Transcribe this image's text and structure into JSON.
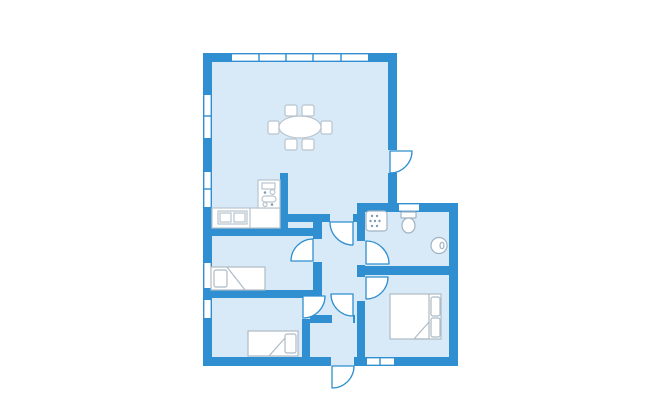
{
  "canvas": {
    "w": 650,
    "h": 420,
    "bg": "#ffffff"
  },
  "colors": {
    "wall": "#2f8fd0",
    "floor": "#d8eaf8",
    "white": "#ffffff",
    "furniture": "#b9c4cd",
    "fixture": "#9fb3c2",
    "bed": "#aebbc5",
    "dots": "#7c9cb4"
  },
  "plan": {
    "blocks": [
      {
        "name": "left-wing-floor",
        "x": 203,
        "y": 53,
        "w": 194,
        "h": 313
      },
      {
        "name": "right-wing-floor",
        "x": 357,
        "y": 203,
        "w": 101,
        "h": 163
      }
    ],
    "walls": [
      {
        "name": "exterior-wall-top",
        "x": 203,
        "y": 53,
        "w": 194,
        "h": 9
      },
      {
        "name": "exterior-wall-left",
        "x": 203,
        "y": 53,
        "w": 9,
        "h": 313
      },
      {
        "name": "living-room-east-wall",
        "x": 388,
        "y": 53,
        "w": 9,
        "h": 159
      },
      {
        "name": "bathroom-north-wall",
        "x": 357,
        "y": 203,
        "w": 101,
        "h": 9
      },
      {
        "name": "exterior-wall-right",
        "x": 449,
        "y": 203,
        "w": 9,
        "h": 163
      },
      {
        "name": "exterior-wall-bottom",
        "x": 203,
        "y": 357,
        "w": 255,
        "h": 9
      },
      {
        "name": "kitchen-partition-wall",
        "x": 280,
        "y": 173,
        "w": 8,
        "h": 63
      },
      {
        "name": "hallway-north-wall",
        "x": 288,
        "y": 214,
        "w": 69,
        "h": 8
      },
      {
        "name": "hallway-west-wall",
        "x": 313,
        "y": 222,
        "w": 9,
        "h": 76
      },
      {
        "name": "bedroom1-north-wall",
        "x": 203,
        "y": 228,
        "w": 119,
        "h": 8
      },
      {
        "name": "bedroom1-south-wall",
        "x": 203,
        "y": 290,
        "w": 119,
        "h": 8
      },
      {
        "name": "bedroom2-east-wall",
        "x": 302,
        "y": 298,
        "w": 8,
        "h": 59
      },
      {
        "name": "bathroom-west-wall",
        "x": 357,
        "y": 212,
        "w": 8,
        "h": 62
      },
      {
        "name": "bathroom-south-wall",
        "x": 357,
        "y": 266,
        "w": 92,
        "h": 9
      },
      {
        "name": "master-bedroom-west-wall",
        "x": 357,
        "y": 275,
        "w": 8,
        "h": 82
      },
      {
        "name": "entry-north-wall",
        "x": 310,
        "y": 315,
        "w": 45,
        "h": 8
      }
    ],
    "door_gaps": [
      {
        "name": "terrace-door-gap",
        "x": 388,
        "y": 150,
        "w": 9,
        "h": 23
      },
      {
        "name": "living-hall-door-gap",
        "x": 330,
        "y": 214,
        "w": 23,
        "h": 8
      },
      {
        "name": "bedroom1-door-gap",
        "x": 313,
        "y": 239,
        "w": 9,
        "h": 23
      },
      {
        "name": "bathroom-door-gap",
        "x": 357,
        "y": 241,
        "w": 8,
        "h": 24
      },
      {
        "name": "master-door-gap",
        "x": 357,
        "y": 277,
        "w": 8,
        "h": 24
      },
      {
        "name": "bedroom2-door-gap",
        "x": 302,
        "y": 298,
        "w": 8,
        "h": 21
      },
      {
        "name": "entry-door-gap",
        "x": 332,
        "y": 315,
        "w": 21,
        "h": 8
      },
      {
        "name": "front-door-gap",
        "x": 331,
        "y": 357,
        "w": 23,
        "h": 9
      }
    ],
    "windows": [
      {
        "name": "living-room-window-north",
        "x": 232,
        "y": 53,
        "w": 136,
        "h": 9,
        "ticks": [
          259,
          286,
          313,
          341
        ]
      },
      {
        "name": "living-room-window-west",
        "x": 203,
        "y": 95,
        "w": 9,
        "h": 43,
        "ticks": [
          116
        ]
      },
      {
        "name": "kitchen-window-west",
        "x": 203,
        "y": 172,
        "w": 9,
        "h": 35,
        "ticks": [
          189
        ]
      },
      {
        "name": "bedroom1-window-west",
        "x": 203,
        "y": 263,
        "w": 9,
        "h": 25,
        "ticks": []
      },
      {
        "name": "bedroom2-window-west",
        "x": 203,
        "y": 300,
        "w": 9,
        "h": 18,
        "ticks": []
      },
      {
        "name": "bathroom-window-north",
        "x": 399,
        "y": 203,
        "w": 20,
        "h": 9,
        "ticks": []
      },
      {
        "name": "master-bedroom-window-south",
        "x": 367,
        "y": 357,
        "w": 27,
        "h": 9,
        "ticks": [
          380
        ]
      }
    ],
    "doors": [
      {
        "name": "terrace-door-swing",
        "hx": 390,
        "hy": 151,
        "r": 22,
        "corner": "tl"
      },
      {
        "name": "living-hall-door-swing",
        "hx": 353,
        "hy": 222,
        "r": 23,
        "corner": "tr"
      },
      {
        "name": "bedroom1-door-swing",
        "hx": 313,
        "hy": 261,
        "r": 22,
        "corner": "br"
      },
      {
        "name": "bathroom-door-swing",
        "hx": 366,
        "hy": 264,
        "r": 23,
        "corner": "bl"
      },
      {
        "name": "master-bedroom-door-swing",
        "hx": 366,
        "hy": 277,
        "r": 22,
        "corner": "tl"
      },
      {
        "name": "bedroom2-door-swing",
        "hx": 303,
        "hy": 296,
        "r": 22,
        "corner": "tl"
      },
      {
        "name": "entry-door-swing",
        "hx": 353,
        "hy": 294,
        "r": 22,
        "corner": "tr"
      },
      {
        "name": "front-door-swing",
        "hx": 332,
        "hy": 366,
        "r": 22,
        "corner": "tl"
      }
    ],
    "furniture": [
      {
        "type": "rect",
        "name": "dining-chair",
        "x": 285,
        "y": 105,
        "w": 12,
        "h": 11,
        "rx": 2,
        "stroke": "furniture"
      },
      {
        "type": "rect",
        "name": "dining-chair",
        "x": 302,
        "y": 105,
        "w": 12,
        "h": 11,
        "rx": 2,
        "stroke": "furniture"
      },
      {
        "type": "rect",
        "name": "dining-chair",
        "x": 285,
        "y": 139,
        "w": 12,
        "h": 11,
        "rx": 2,
        "stroke": "furniture"
      },
      {
        "type": "rect",
        "name": "dining-chair",
        "x": 302,
        "y": 139,
        "w": 12,
        "h": 11,
        "rx": 2,
        "stroke": "furniture"
      },
      {
        "type": "rect",
        "name": "dining-chair",
        "x": 268,
        "y": 121,
        "w": 11,
        "h": 13,
        "rx": 2,
        "stroke": "furniture"
      },
      {
        "type": "rect",
        "name": "dining-chair",
        "x": 321,
        "y": 121,
        "w": 11,
        "h": 13,
        "rx": 2,
        "stroke": "furniture"
      },
      {
        "type": "ellipse",
        "name": "dining-table",
        "cx": 300,
        "cy": 127,
        "rx": 21,
        "ry": 11,
        "stroke": "furniture"
      },
      {
        "type": "rect",
        "name": "kitchen-counter",
        "x": 212,
        "y": 208,
        "w": 68,
        "h": 20,
        "stroke": "furniture"
      },
      {
        "type": "line",
        "name": "kitchen-counter-seam",
        "x1": 250,
        "y1": 208,
        "x2": 250,
        "y2": 228,
        "stroke": "furniture"
      },
      {
        "type": "rect",
        "name": "kitchen-sink",
        "x": 218,
        "y": 211,
        "w": 29,
        "h": 13,
        "stroke": "furniture"
      },
      {
        "type": "rect",
        "name": "kitchen-sink-bowl",
        "x": 220,
        "y": 213,
        "w": 11,
        "h": 9,
        "stroke": "furniture"
      },
      {
        "type": "rect",
        "name": "kitchen-sink-bowl",
        "x": 234,
        "y": 213,
        "w": 11,
        "h": 9,
        "stroke": "furniture"
      },
      {
        "type": "rect",
        "name": "stove-unit",
        "x": 258,
        "y": 180,
        "w": 22,
        "h": 28,
        "stroke": "furniture"
      },
      {
        "type": "rect",
        "name": "stove-panel",
        "x": 262,
        "y": 183,
        "w": 13,
        "h": 6,
        "stroke": "furniture"
      },
      {
        "type": "dot",
        "name": "stove-burner",
        "cx": 265,
        "cy": 192.5,
        "r": 1.3
      },
      {
        "type": "circle",
        "name": "stove-burner",
        "cx": 272.5,
        "cy": 192,
        "r": 2.4,
        "stroke": "furniture"
      },
      {
        "type": "rect",
        "name": "stove-oven",
        "x": 262,
        "y": 196,
        "w": 14,
        "h": 6,
        "rx": 3,
        "stroke": "furniture"
      },
      {
        "type": "circle",
        "name": "stove-burner",
        "cx": 265,
        "cy": 204.5,
        "r": 2,
        "stroke": "furniture"
      },
      {
        "type": "dot",
        "name": "stove-burner",
        "cx": 272,
        "cy": 204.5,
        "r": 1.3
      },
      {
        "type": "rect",
        "name": "shower",
        "x": 366,
        "y": 211,
        "w": 21,
        "h": 20,
        "rx": 3,
        "stroke": "fixture"
      },
      {
        "type": "dot",
        "name": "shower-dot",
        "cx": 372,
        "cy": 216,
        "r": 1.2
      },
      {
        "type": "dot",
        "name": "shower-dot",
        "cx": 377,
        "cy": 216,
        "r": 1.2
      },
      {
        "type": "dot",
        "name": "shower-dot",
        "cx": 370.5,
        "cy": 221,
        "r": 1.2
      },
      {
        "type": "dot",
        "name": "shower-dot",
        "cx": 375,
        "cy": 221,
        "r": 1.2
      },
      {
        "type": "dot",
        "name": "shower-dot",
        "cx": 379.5,
        "cy": 221,
        "r": 1.2
      },
      {
        "type": "dot",
        "name": "shower-dot",
        "cx": 372,
        "cy": 226,
        "r": 1.2
      },
      {
        "type": "dot",
        "name": "shower-dot",
        "cx": 377,
        "cy": 226,
        "r": 1.2
      },
      {
        "type": "rect",
        "name": "toilet-tank",
        "x": 401,
        "y": 212,
        "w": 15,
        "h": 6,
        "rx": 1,
        "stroke": "fixture"
      },
      {
        "type": "ellipse",
        "name": "toilet-bowl",
        "cx": 408.5,
        "cy": 225.5,
        "rx": 6.5,
        "ry": 7.5,
        "stroke": "fixture"
      },
      {
        "type": "circle",
        "name": "washbasin",
        "cx": 439,
        "cy": 245.5,
        "r": 8,
        "stroke": "fixture"
      },
      {
        "type": "ellipse",
        "name": "washbasin-tap",
        "cx": 442,
        "cy": 245.5,
        "rx": 2,
        "ry": 3.2,
        "stroke": "fixture"
      },
      {
        "type": "rect",
        "name": "single-bed-1",
        "x": 211,
        "y": 267,
        "w": 54,
        "h": 23,
        "stroke": "bed"
      },
      {
        "type": "rect",
        "name": "single-bed-1-pillow",
        "x": 214,
        "y": 270,
        "w": 13,
        "h": 17,
        "rx": 2,
        "stroke": "bed"
      },
      {
        "type": "line",
        "name": "single-bed-1-fold",
        "x1": 227,
        "y1": 267,
        "x2": 245,
        "y2": 290,
        "stroke": "bed"
      },
      {
        "type": "rect",
        "name": "single-bed-2",
        "x": 248,
        "y": 331,
        "w": 50,
        "h": 25,
        "stroke": "bed"
      },
      {
        "type": "rect",
        "name": "single-bed-2-pillow",
        "x": 285,
        "y": 334,
        "w": 11,
        "h": 19,
        "rx": 2,
        "stroke": "bed"
      },
      {
        "type": "line",
        "name": "single-bed-2-fold",
        "x1": 285,
        "y1": 338,
        "x2": 269,
        "y2": 356,
        "stroke": "bed"
      },
      {
        "type": "rect",
        "name": "double-bed",
        "x": 390,
        "y": 294,
        "w": 51,
        "h": 45,
        "stroke": "bed"
      },
      {
        "type": "line",
        "name": "double-bed-head-line",
        "x1": 429,
        "y1": 294,
        "x2": 429,
        "y2": 339,
        "stroke": "bed"
      },
      {
        "type": "rect",
        "name": "double-bed-pillow",
        "x": 431,
        "y": 297,
        "w": 9,
        "h": 19,
        "rx": 2,
        "stroke": "bed"
      },
      {
        "type": "rect",
        "name": "double-bed-pillow",
        "x": 431,
        "y": 318,
        "w": 9,
        "h": 19,
        "rx": 2,
        "stroke": "bed"
      },
      {
        "type": "path",
        "name": "double-bed-fold",
        "d": "M429,322 L414,339 L429,339",
        "stroke": "bed"
      }
    ]
  }
}
